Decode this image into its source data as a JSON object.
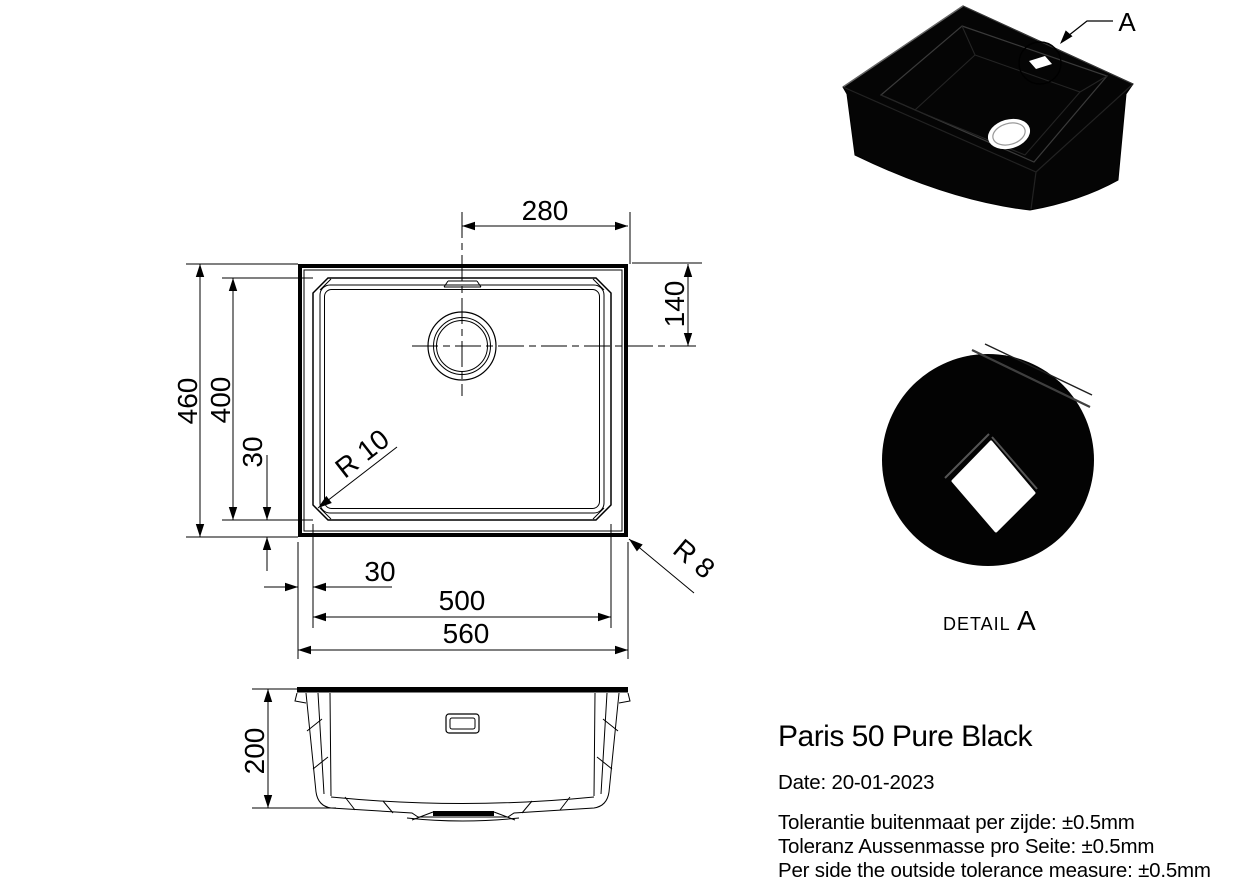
{
  "colors": {
    "ink": "#000000",
    "paper": "#ffffff",
    "sink": "#050505"
  },
  "top_view": {
    "dims": {
      "drain_from_right": "280",
      "drain_from_top": "140",
      "overall_depth": "460",
      "bowl_depth": "400",
      "side_offset": "30",
      "bottom_offset": "30",
      "bowl_width": "500",
      "overall_width": "560"
    },
    "radii": {
      "bowl_corner": "R 10",
      "outer_corner": "R 8"
    }
  },
  "section_view": {
    "dims": {
      "depth": "200"
    }
  },
  "iso_view": {
    "callout": "A"
  },
  "detail_view": {
    "label": "DETAIL",
    "callout": "A"
  },
  "title_block": {
    "product": "Paris 50 Pure Black",
    "date": "Date: 20-01-2023",
    "tolerances": [
      "Tolerantie buitenmaat per zijde: ±0.5mm",
      "Toleranz Aussenmasse pro Seite: ±0.5mm",
      "Per side the outside tolerance measure: ±0.5mm"
    ]
  }
}
